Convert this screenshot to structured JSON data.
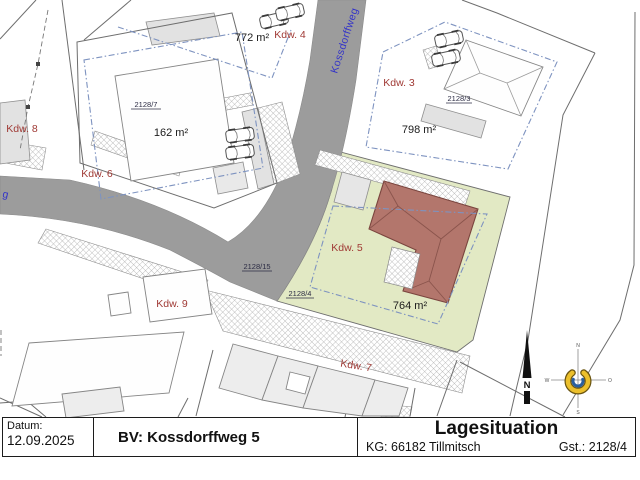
{
  "title_block": {
    "date_label": "Datum:",
    "date_value": "12.09.2025",
    "project": "BV: Kossdorffweg 5",
    "title": "Lagesituation",
    "cadastral_municipality": "KG: 66182 Tillmitsch",
    "parcel": "Gst.: 2128/4"
  },
  "map": {
    "street_name": "Kossdorffweg",
    "street_name_partial": "g",
    "road_parcel_label": "2128/15",
    "plots": [
      {
        "label": "Kdw. 8"
      },
      {
        "label": "Kdw. 6",
        "area": "162 m²",
        "parcel": "2128/7"
      },
      {
        "label": "Kdw. 4",
        "area": "772 m²"
      },
      {
        "label": "Kdw. 3",
        "area": "798 m²",
        "parcel": "2128/3"
      },
      {
        "label": "Kdw. 5",
        "area": "764 m²",
        "parcel": "2128/4"
      },
      {
        "label": "Kdw. 9"
      },
      {
        "label": "Kdw. 7"
      }
    ],
    "north_arrow_label": "N",
    "compass_labels": {
      "north": "N",
      "east": "O",
      "south": "S",
      "west": "W"
    },
    "colors": {
      "road": "#9c9c9c",
      "highlight_plot": "#e2e9c4",
      "new_building_roof": "#b3766c",
      "boundary_dashdot": "#7e93c0",
      "label_red": "#a03a35",
      "street_blue": "#3434c8"
    }
  }
}
